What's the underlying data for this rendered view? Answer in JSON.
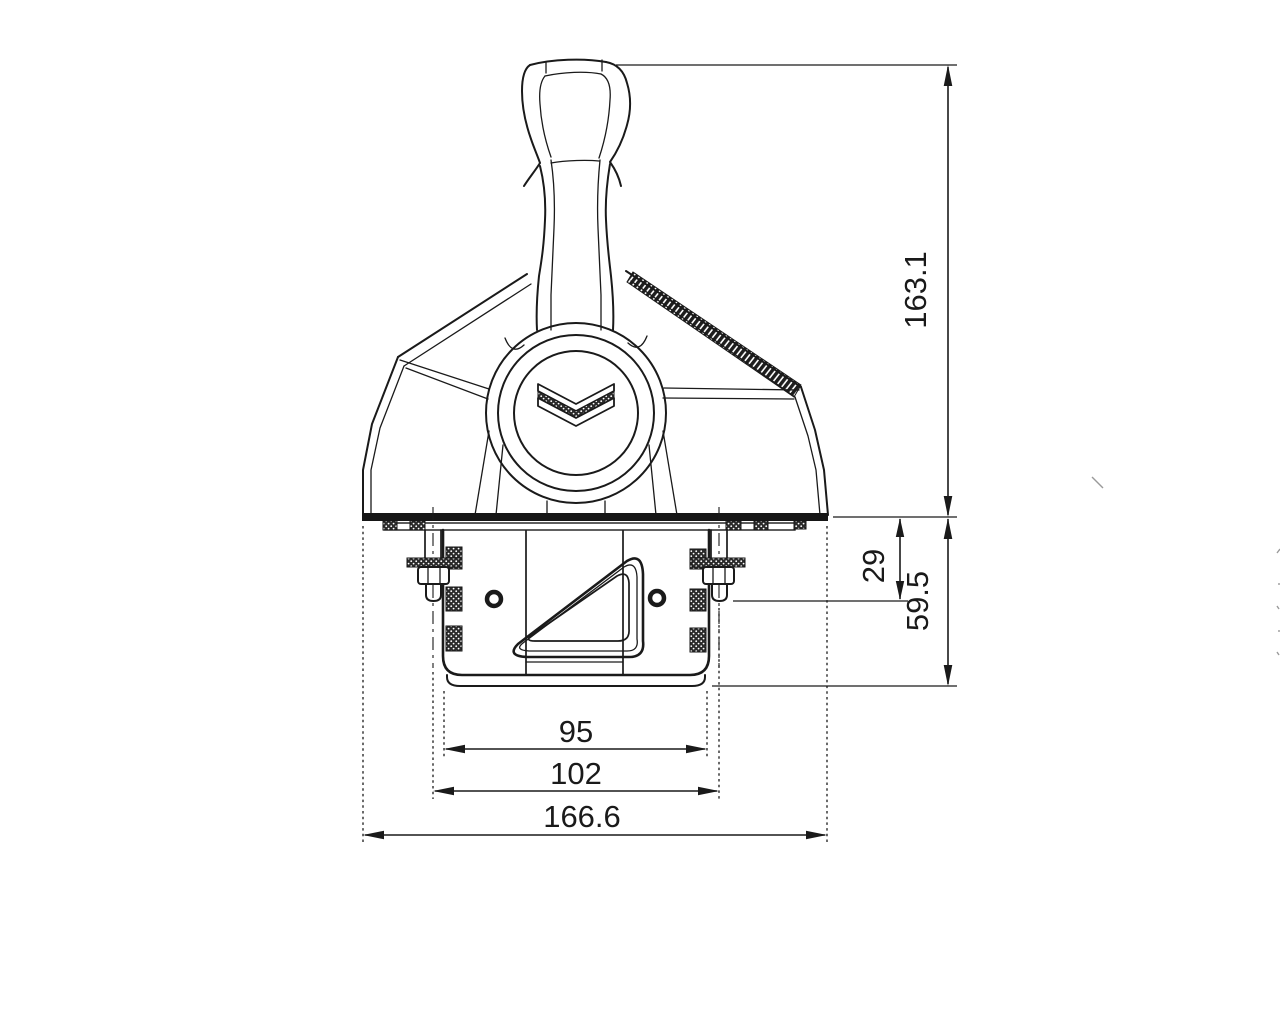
{
  "drawing": {
    "background": "#ffffff",
    "line_color": "#1a1a1a",
    "emblem_icon": "double-chevron-down",
    "dimensions": {
      "overall_height": "163.1",
      "plate_to_stud_tip": "29",
      "under_panel_depth": "59.5",
      "housing_width": "95",
      "stud_spacing": "102",
      "base_plate_width": "166.6"
    }
  }
}
